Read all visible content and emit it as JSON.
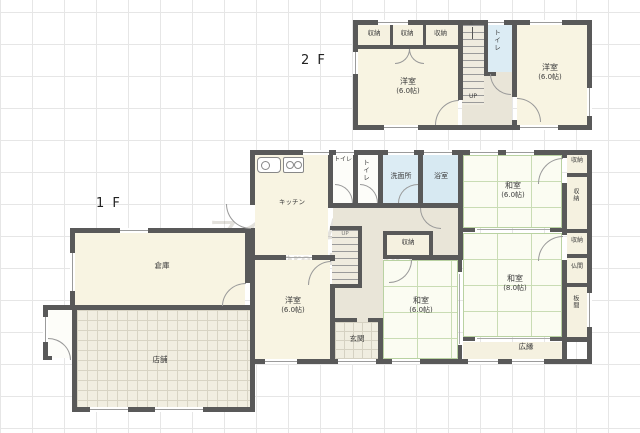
{
  "watermark": {
    "line1": "マイホームクラウド",
    "line2": "Powered by WebCAD.JP"
  },
  "colors": {
    "wall": "#595959",
    "tatami_line": "#c9dcb4",
    "water_room": "#dcecf4",
    "room_cream": "#f8f4e2"
  },
  "floor2": {
    "label": "2 F",
    "closet1": "収納",
    "closet2": "収納",
    "closet3": "収納",
    "room_left_name": "洋室",
    "room_left_size": "(6.0帖)",
    "toilet": "トイレ",
    "up": "UP",
    "room_right_name": "洋室",
    "room_right_size": "(6.0帖)"
  },
  "floor1": {
    "label": "1 F",
    "kitchen": "キッチン",
    "toilet_a": "トイレ",
    "toilet_b": "トイレ",
    "washroom": "洗面所",
    "bathroom": "浴室",
    "closet_center": "収納",
    "up": "UP",
    "western_name": "洋室",
    "western_size": "(6.0帖)",
    "entrance": "玄関",
    "japanese_c_name": "和室",
    "japanese_c_size": "(6.0帖)",
    "japanese_ne_name": "和室",
    "japanese_ne_size": "(6.0帖)",
    "japanese_8_name": "和室",
    "japanese_8_size": "(8.0帖)",
    "veranda": "広縁",
    "closet_r1": "収納",
    "closet_r2": "収納",
    "closet_r3": "収納",
    "butsuma": "仏間",
    "itanoma": "板間",
    "warehouse": "倉庫",
    "shop": "店舗"
  }
}
